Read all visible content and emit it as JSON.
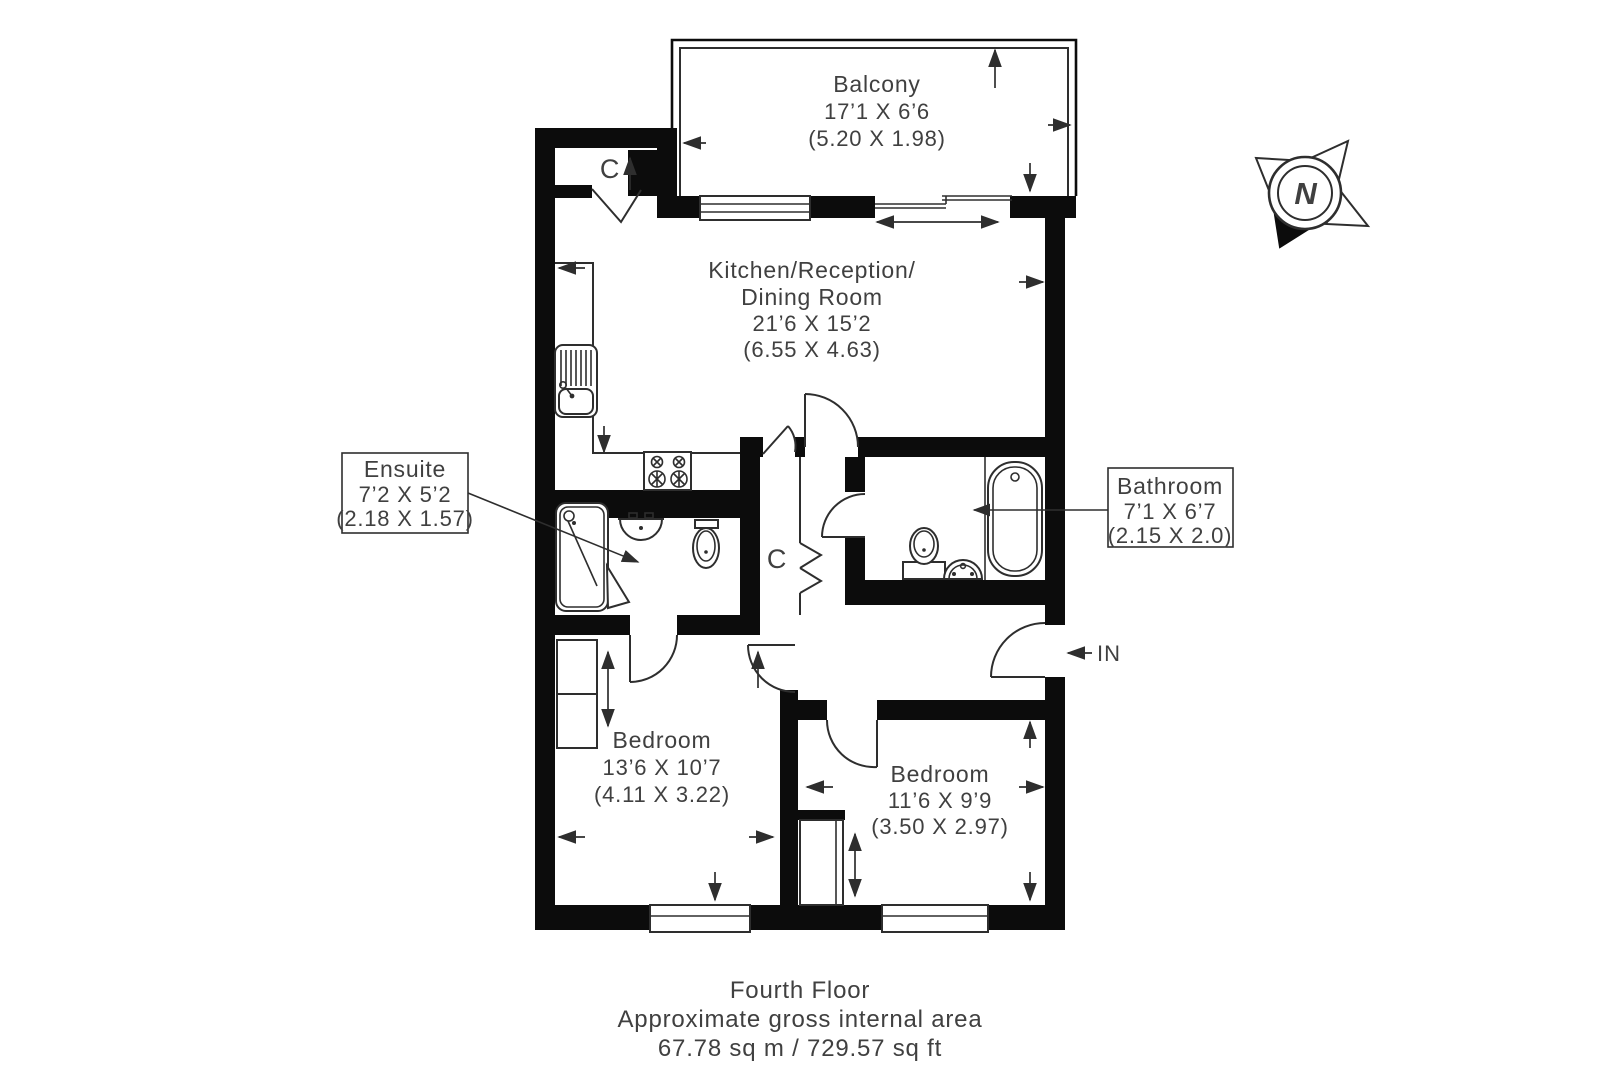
{
  "plan": {
    "rooms": {
      "balcony": {
        "name": "Balcony",
        "imperial": "17’1 X 6’6",
        "metric": "(5.20 X 1.98)"
      },
      "kitchen": {
        "name1": "Kitchen/Reception/",
        "name2": "Dining Room",
        "imperial": "21’6 X 15’2",
        "metric": "(6.55 X 4.63)"
      },
      "ensuite": {
        "name": "Ensuite",
        "imperial": "7’2 X 5’2",
        "metric": "(2.18 X 1.57)"
      },
      "bathroom": {
        "name": "Bathroom",
        "imperial": "7’1 X 6’7",
        "metric": "(2.15 X 2.0)"
      },
      "bedroom1": {
        "name": "Bedroom",
        "imperial": "13’6 X 10’7",
        "metric": "(4.11 X 3.22)"
      },
      "bedroom2": {
        "name": "Bedroom",
        "imperial": "11’6 X 9’9",
        "metric": "(3.50 X 2.97)"
      }
    },
    "markers": {
      "closet_top": "C",
      "closet_hall": "C",
      "entrance": "IN",
      "compass_north": "N"
    },
    "footer": {
      "floor": "Fourth Floor",
      "area_label": "Approximate gross internal area",
      "area_value": "67.78 sq m / 729.57 sq ft"
    },
    "colors": {
      "wall": "#0c0c0c",
      "line": "#2e2e2e",
      "text": "#404040",
      "background": "#ffffff"
    }
  }
}
